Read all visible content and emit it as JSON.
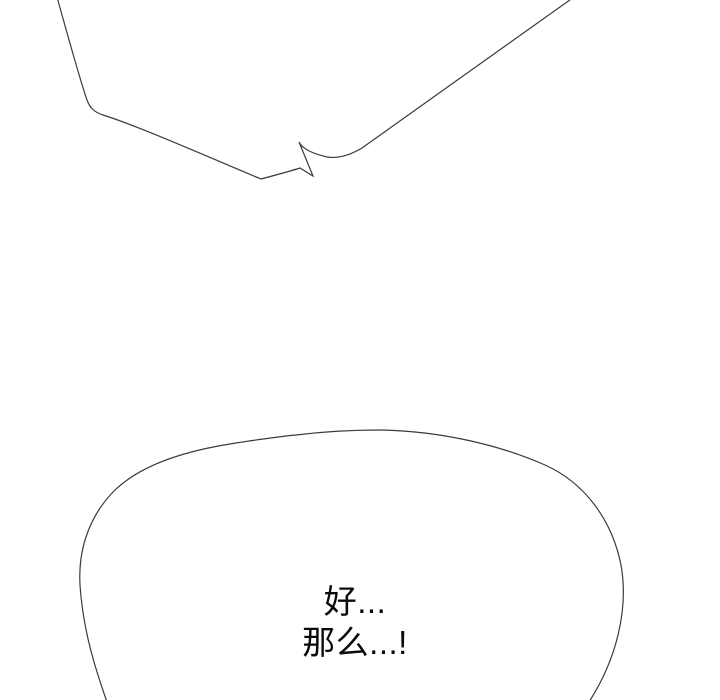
{
  "canvas": {
    "width": 720,
    "height": 700,
    "background": "#ffffff",
    "line_color": "#3a3a3a",
    "text_color": "#0a0a0a"
  },
  "panel": {
    "type": "webtoon-comic-panel"
  },
  "speech": {
    "top_bubble": {
      "shape": "jagged-speech-bubble-partial-cut-off-at-top",
      "text": ""
    },
    "bottom_bubble": {
      "shape": "oval-speech-bubble-cut-off-at-bottom",
      "line1": "好...",
      "line2": "那么...!"
    }
  }
}
